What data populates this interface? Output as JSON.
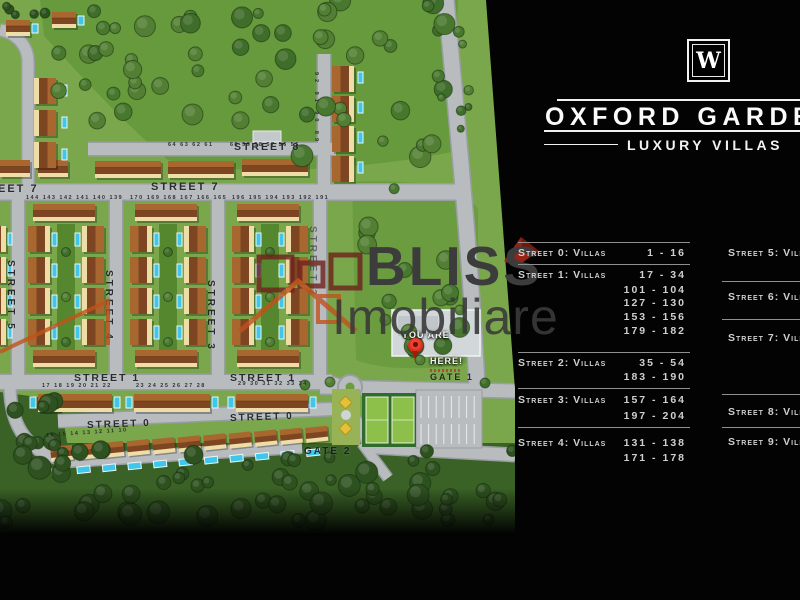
{
  "brand": {
    "logo_letter": "W",
    "title": "OXFORD GARDENS",
    "subtitle": "LUXURY VILLAS"
  },
  "watermark": {
    "line1": "BLISS",
    "line2": "Imobiliare"
  },
  "legend": {
    "left": [
      {
        "label": "Street 0: Villas",
        "ranges": [
          "1 - 16"
        ]
      },
      {
        "label": "Street 1: Villas",
        "ranges": [
          "17 - 34",
          "101 - 104",
          "127 - 130",
          "153 - 156",
          "179 - 182"
        ]
      },
      {
        "label": "Street 2: Villas",
        "ranges": [
          "35 - 54",
          "183 - 190"
        ]
      },
      {
        "label": "Street 3: Villas",
        "ranges": [
          "157 - 164",
          "197 - 204"
        ]
      },
      {
        "label": "Street 4: Villas",
        "ranges": [
          "131 - 138",
          "171 - 178"
        ]
      }
    ],
    "right": [
      {
        "label": "Street 5: Villas",
        "ranges": []
      },
      {
        "label": "Street 6: Villas",
        "ranges": []
      },
      {
        "label": "Street 7: Villas",
        "ranges": []
      },
      {
        "label": "Street 8: Villas",
        "ranges": []
      },
      {
        "label": "Street 9: Villas",
        "ranges": []
      }
    ]
  },
  "map": {
    "streets": [
      {
        "id": "street-8",
        "text": "Street 8"
      },
      {
        "id": "street-7",
        "text": "Street 7"
      },
      {
        "id": "street-7-left",
        "text": "Street 7"
      },
      {
        "id": "street-5",
        "text": "Street 5"
      },
      {
        "id": "street-4",
        "text": "Street 4"
      },
      {
        "id": "street-3",
        "text": "Street 3"
      },
      {
        "id": "street-2",
        "text": "Street 2"
      },
      {
        "id": "street-1-a",
        "text": "Street 1"
      },
      {
        "id": "street-1-b",
        "text": "Street 1"
      },
      {
        "id": "street-0-a",
        "text": "Street 0"
      },
      {
        "id": "street-0-b",
        "text": "Street 0"
      },
      {
        "id": "gate-1",
        "text": "Gate 1"
      },
      {
        "id": "gate-2",
        "text": "Gate 2"
      }
    ],
    "marker": {
      "line1": "YOU ARE",
      "line2": "HERE!"
    },
    "house_numbers": [
      "64 63 62 61",
      "60 59 58 57 56 55",
      "144 143 142 141 140 139",
      "170 169 168 167 166 165",
      "196 195 194 193 192 191",
      "17 18 19 20 21 22",
      "23 24 25 26 27 28",
      "29 30 31 32 33 34",
      "16 15 14 13 12 11 10",
      "92 91 90 89"
    ]
  },
  "colors": {
    "background": "#030303",
    "legend_text": "#cfcfcf",
    "title_text": "#fafafa",
    "map_green": "#7aa74b",
    "forest_green": "#3a6226",
    "road_gray": "#b8bcbf",
    "roof_brown": "#9a5229",
    "pool_blue": "#3fc6e8",
    "pin_red": "#d8291c",
    "watermark_gray": "#3c3c3c",
    "logo_orange": "#c2511c"
  }
}
